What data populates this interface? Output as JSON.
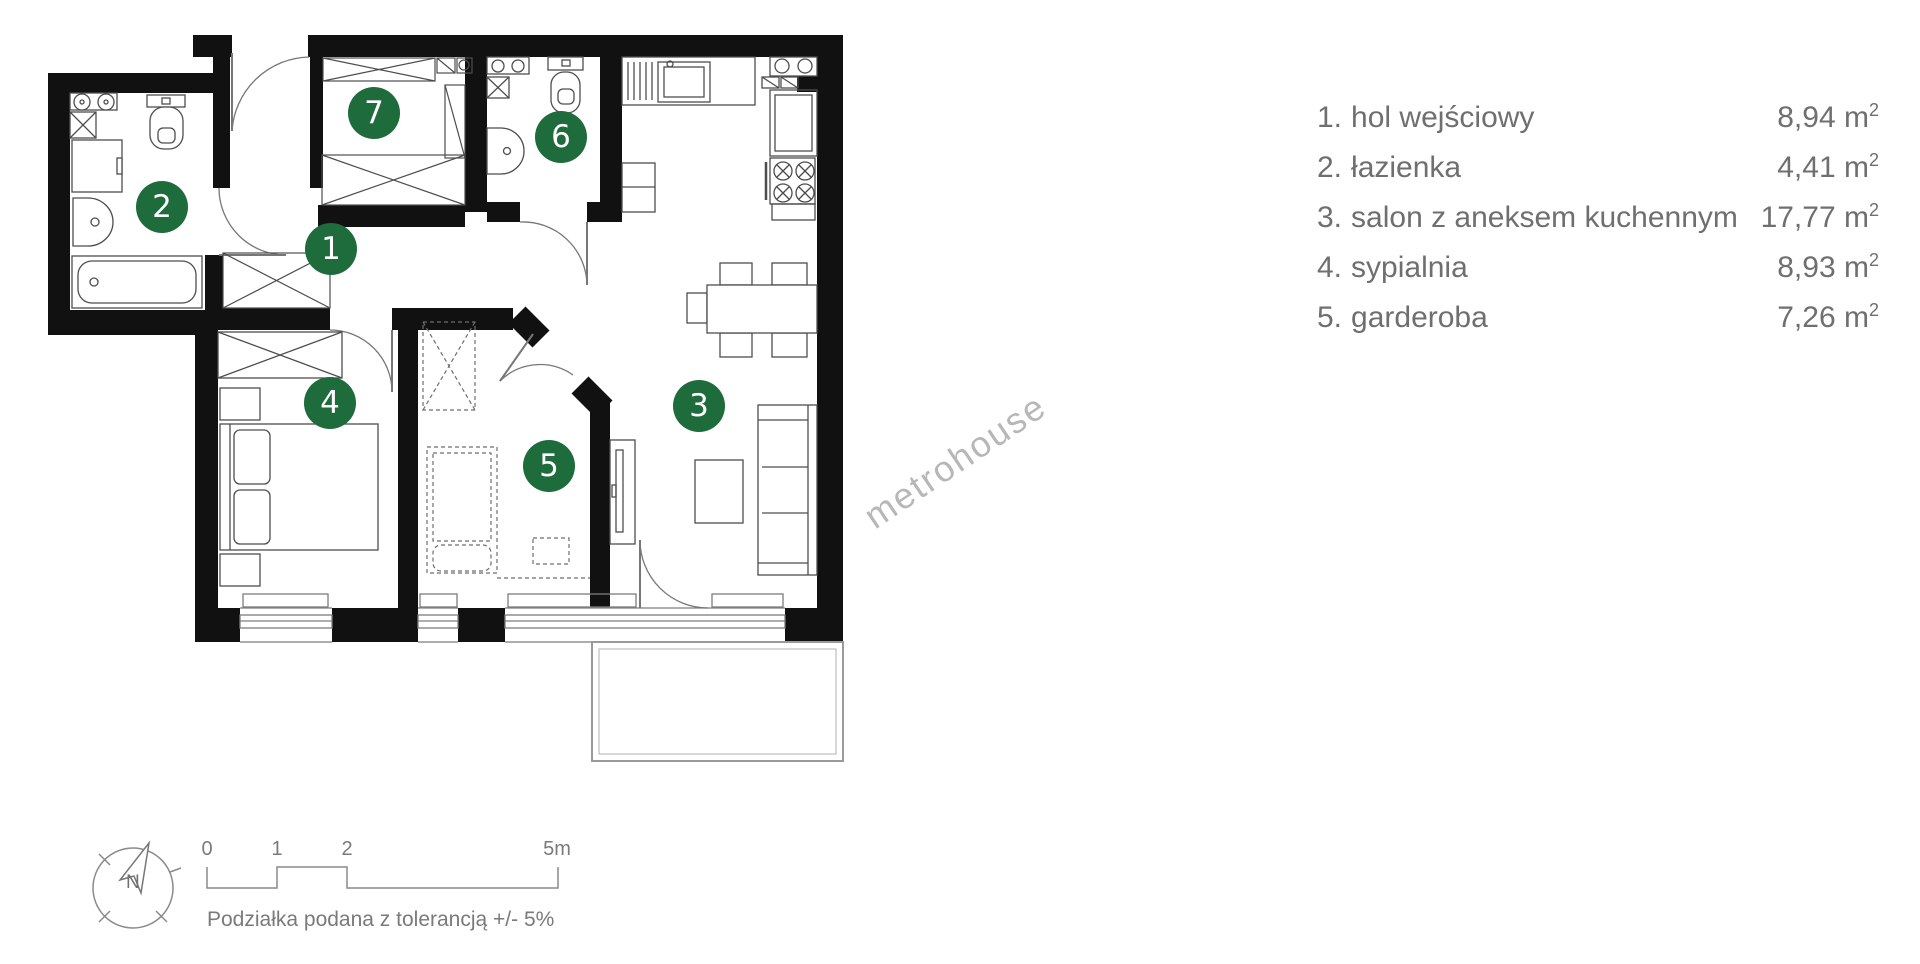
{
  "legend": {
    "rows": [
      {
        "num": "1.",
        "name": "hol wejściowy",
        "area": "8,94"
      },
      {
        "num": "2.",
        "name": "łazienka",
        "area": "4,41"
      },
      {
        "num": "3.",
        "name": "salon z aneksem kuchennym",
        "area": "17,77"
      },
      {
        "num": "4.",
        "name": "sypialnia",
        "area": "8,93"
      },
      {
        "num": "5.",
        "name": "garderoba",
        "area": "7,26"
      }
    ],
    "unit": "m",
    "unit_sup": "2"
  },
  "plan": {
    "markers": [
      {
        "number": "1"
      },
      {
        "number": "2"
      },
      {
        "number": "3"
      },
      {
        "number": "4"
      },
      {
        "number": "5"
      },
      {
        "number": "6"
      },
      {
        "number": "7"
      }
    ],
    "compass_label": "N"
  },
  "scale_bar": {
    "ticks": [
      "0",
      "1",
      "2",
      "5m"
    ],
    "caption": "Podziałka podana z tolerancją +/- 5%"
  },
  "watermark": "metrohouse",
  "colors": {
    "marker_green": "#1e6b3b",
    "wall_black": "#111111",
    "fixture_line": "#4d4d4d",
    "light_line": "#8a8a8a",
    "watermark_gray": "#b7b7b7",
    "legend_text": "#6f6f6f"
  }
}
